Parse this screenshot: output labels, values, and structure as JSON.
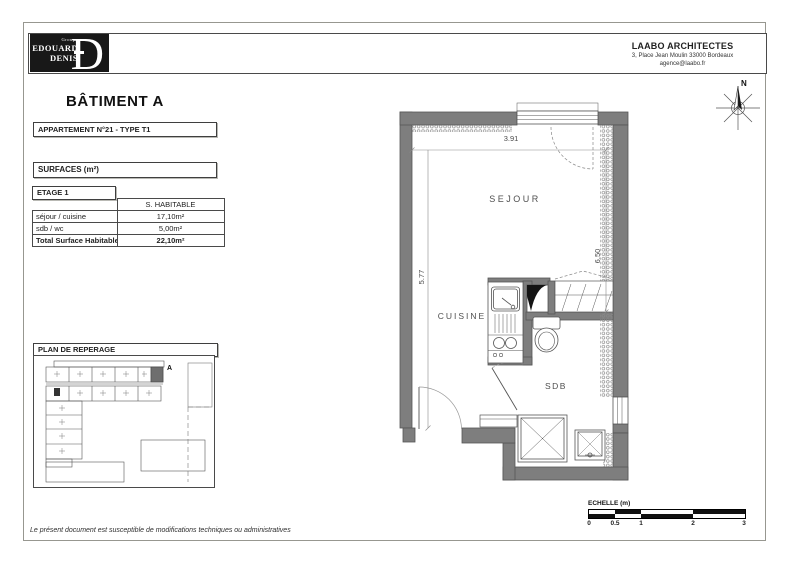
{
  "header": {
    "logo": {
      "group": "Groupe",
      "line1": "EDOUARD",
      "line2": "DENIS",
      "monogram": "D"
    },
    "architect": {
      "name": "LAABO ARCHITECTES",
      "address": "3, Place Jean Moulin  33000 Bordeaux",
      "email": "agence@laabo.fr"
    }
  },
  "titles": {
    "building": "BÂTIMENT A",
    "apartment": "APPARTEMENT N°21 - TYPE T1"
  },
  "surfaces": {
    "title": "SURFACES (m²)",
    "floor": "ETAGE 1",
    "col_header": "S. HABITABLE",
    "rows": [
      {
        "label": "séjour / cuisine",
        "value": "17,10m²"
      },
      {
        "label": "sdb / wc",
        "value": "5,00m²"
      }
    ],
    "total": {
      "label": "Total Surface Habitable",
      "value": "22,10m²"
    }
  },
  "site_plan": {
    "title": "PLAN DE REPERAGE",
    "building_label": "A"
  },
  "floor_plan": {
    "room_labels": {
      "sejour": "SEJOUR",
      "cuisine": "CUISINE",
      "sdb": "SDB"
    },
    "dimensions": {
      "width_top": "3.91",
      "height_left": "5.77",
      "height_right": "6.50"
    },
    "compass_label": "N"
  },
  "scale_bar": {
    "title": "ECHELLE (m)",
    "ticks": [
      "0",
      "0.5",
      "1",
      "2",
      "3"
    ]
  },
  "footer": {
    "disclaimer": "Le présent document est susceptible de modifications techniques ou administratives"
  },
  "colors": {
    "wall": "#7e7e7e",
    "logo_bg": "#181818",
    "highlight_unit": "#6e6e6e"
  }
}
